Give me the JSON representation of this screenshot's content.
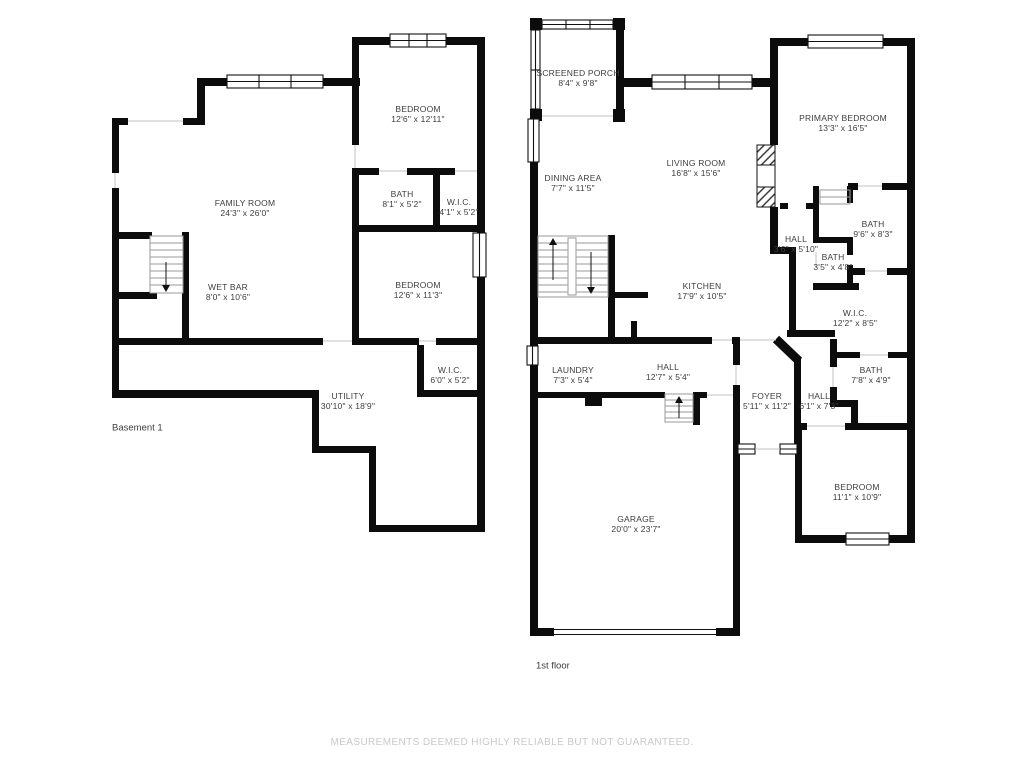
{
  "page": {
    "background": "#ffffff",
    "wall_color": "#0c0c0c",
    "disclaimer": "MEASUREMENTS DEEMED HIGHLY RELIABLE BUT NOT GUARANTEED."
  },
  "floors": [
    {
      "name": "Basement 1",
      "rooms": [
        {
          "name": "FAMILY ROOM",
          "dims": "24'3\" x 26'0\""
        },
        {
          "name": "BEDROOM",
          "dims": "12'6\" x 12'11\""
        },
        {
          "name": "BATH",
          "dims": "8'1\" x 5'2\""
        },
        {
          "name": "W.I.C.",
          "dims": "4'1\" x 5'2\""
        },
        {
          "name": "BEDROOM",
          "dims": "12'6\" x 11'3\""
        },
        {
          "name": "WET BAR",
          "dims": "8'0\" x 10'6\""
        },
        {
          "name": "W.I.C.",
          "dims": "6'0\" x 5'2\""
        },
        {
          "name": "UTILITY",
          "dims": "30'10\" x 18'9\""
        }
      ]
    },
    {
      "name": "1st floor",
      "rooms": [
        {
          "name": "SCREENED PORCH",
          "dims": "8'4\" x 9'8\""
        },
        {
          "name": "DINING AREA",
          "dims": "7'7\" x 11'5\""
        },
        {
          "name": "LIVING ROOM",
          "dims": "16'8\" x 15'6\""
        },
        {
          "name": "PRIMARY BEDROOM",
          "dims": "13'3\" x 16'5\""
        },
        {
          "name": "HALL",
          "dims": "3'6\" x 5'10\""
        },
        {
          "name": "BATH",
          "dims": "9'6\" x 8'3\""
        },
        {
          "name": "BATH",
          "dims": "3'5\" x 4'8\""
        },
        {
          "name": "KITCHEN",
          "dims": "17'9\" x 10'5\""
        },
        {
          "name": "W.I.C.",
          "dims": "12'2\" x 8'5\""
        },
        {
          "name": "BATH",
          "dims": "7'8\" x 4'9\""
        },
        {
          "name": "LAUNDRY",
          "dims": "7'3\" x 5'4\""
        },
        {
          "name": "HALL",
          "dims": "12'7\" x 5'4\""
        },
        {
          "name": "FOYER",
          "dims": "5'11\" x 11'2\""
        },
        {
          "name": "HALL",
          "dims": "6'1\" x 7'3\""
        },
        {
          "name": "BEDROOM",
          "dims": "11'1\" x 10'9\""
        },
        {
          "name": "GARAGE",
          "dims": "20'0\" x 23'7\""
        }
      ]
    }
  ]
}
